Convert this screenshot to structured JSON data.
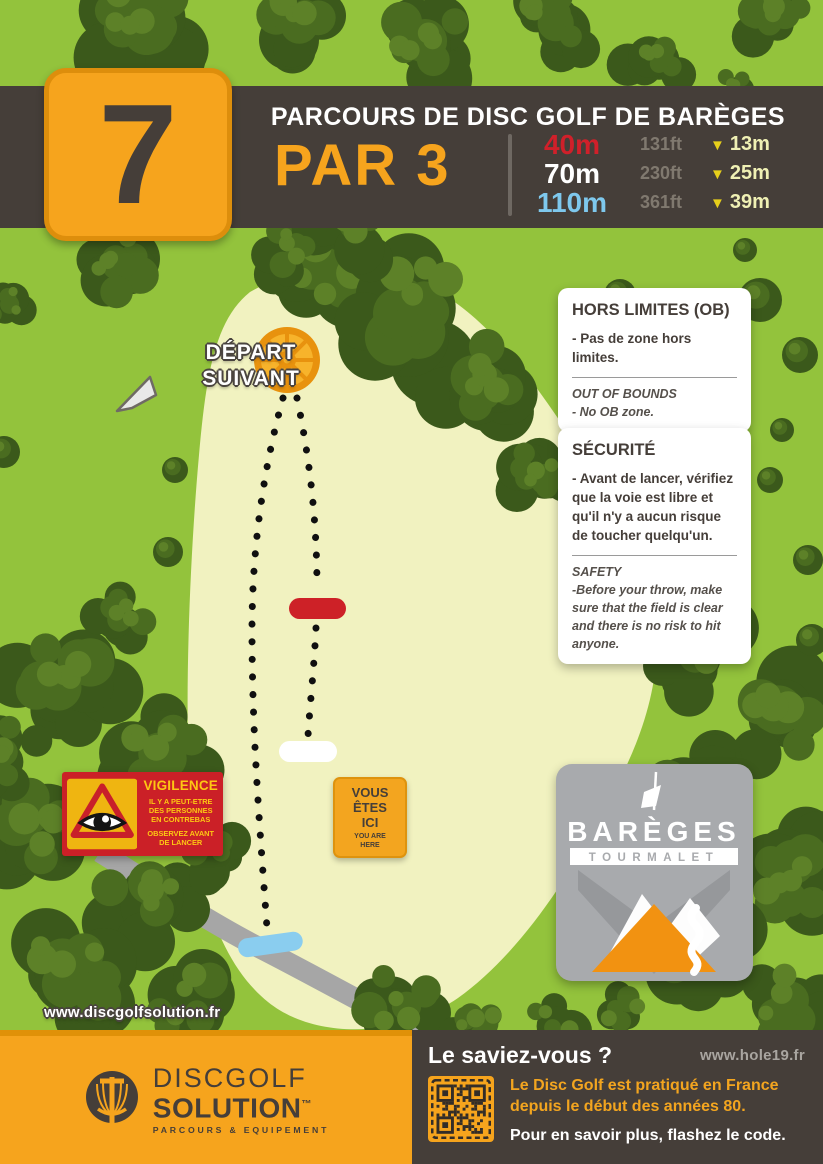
{
  "header": {
    "hole_number": "7",
    "course_title": "PARCOURS DE DISC GOLF DE BARÈGES",
    "par_label": "PAR 3",
    "tees": [
      {
        "distance_m": "40m",
        "distance_ft": "131ft",
        "drop_m": "13m",
        "color": "#d0202a"
      },
      {
        "distance_m": "70m",
        "distance_ft": "230ft",
        "drop_m": "25m",
        "color": "#ffffff"
      },
      {
        "distance_m": "110m",
        "distance_ft": "361ft",
        "drop_m": "39m",
        "color": "#7ec8ed"
      }
    ]
  },
  "icons": {
    "drop_arrow": "▼"
  },
  "map": {
    "next_tee_line1": "DÉPART",
    "next_tee_line2": "SUIVANT"
  },
  "ob_box": {
    "title": "HORS LIMITES (OB)",
    "fr_text": "- Pas de zone hors limites.",
    "en_title": "OUT OF BOUNDS",
    "en_text": "- No OB zone."
  },
  "safety_box": {
    "title": "SÉCURITÉ",
    "fr_text": "- Avant de lancer, vérifiez que la voie est libre et qu'il n'y a aucun risque de toucher quelqu'un.",
    "en_title": "SAFETY",
    "en_text": "-Before your throw, make sure that the field is clear and there is no risk to hit anyone."
  },
  "vigilance": {
    "title": "VIGILENCE",
    "warning": "IL Y A PEUT-ETRE DES PERSONNES EN CONTREBAS",
    "instruction": "OBSERVEZ AVANT DE LANCER"
  },
  "you_are_here": {
    "line1": "VOUS",
    "line2": "ÊTES",
    "line3": "ICI",
    "sub_line1": "YOU ARE",
    "sub_line2": "HERE"
  },
  "bareges": {
    "name": "BARÈGES",
    "subtitle": "TOURMALET"
  },
  "map_website": "www.discgolfsolution.fr",
  "footer": {
    "brand_line1": "DISCGOLF",
    "brand_line2": "SOLUTION",
    "brand_tm": "™",
    "brand_tagline": "PARCOURS & EQUIPEMENT",
    "fact_title": "Le saviez-vous ?",
    "website": "www.hole19.fr",
    "fact_line1": "Le Disc Golf est pratiqué en France",
    "fact_line2": "depuis le début des années 80.",
    "cta": "Pour en savoir plus, flashez le code."
  },
  "colors": {
    "background_green": "#93c33c",
    "tree_green": "#47691f",
    "fairway": "#f1f2c0",
    "band_dark": "#453e39",
    "accent_orange": "#f6a41d",
    "tee_red": "#cd2127",
    "tee_blue": "#8acdef",
    "warning_red": "#cb2027",
    "sign_yellow": "#fdc713",
    "road_gray": "#a6a6a6"
  }
}
